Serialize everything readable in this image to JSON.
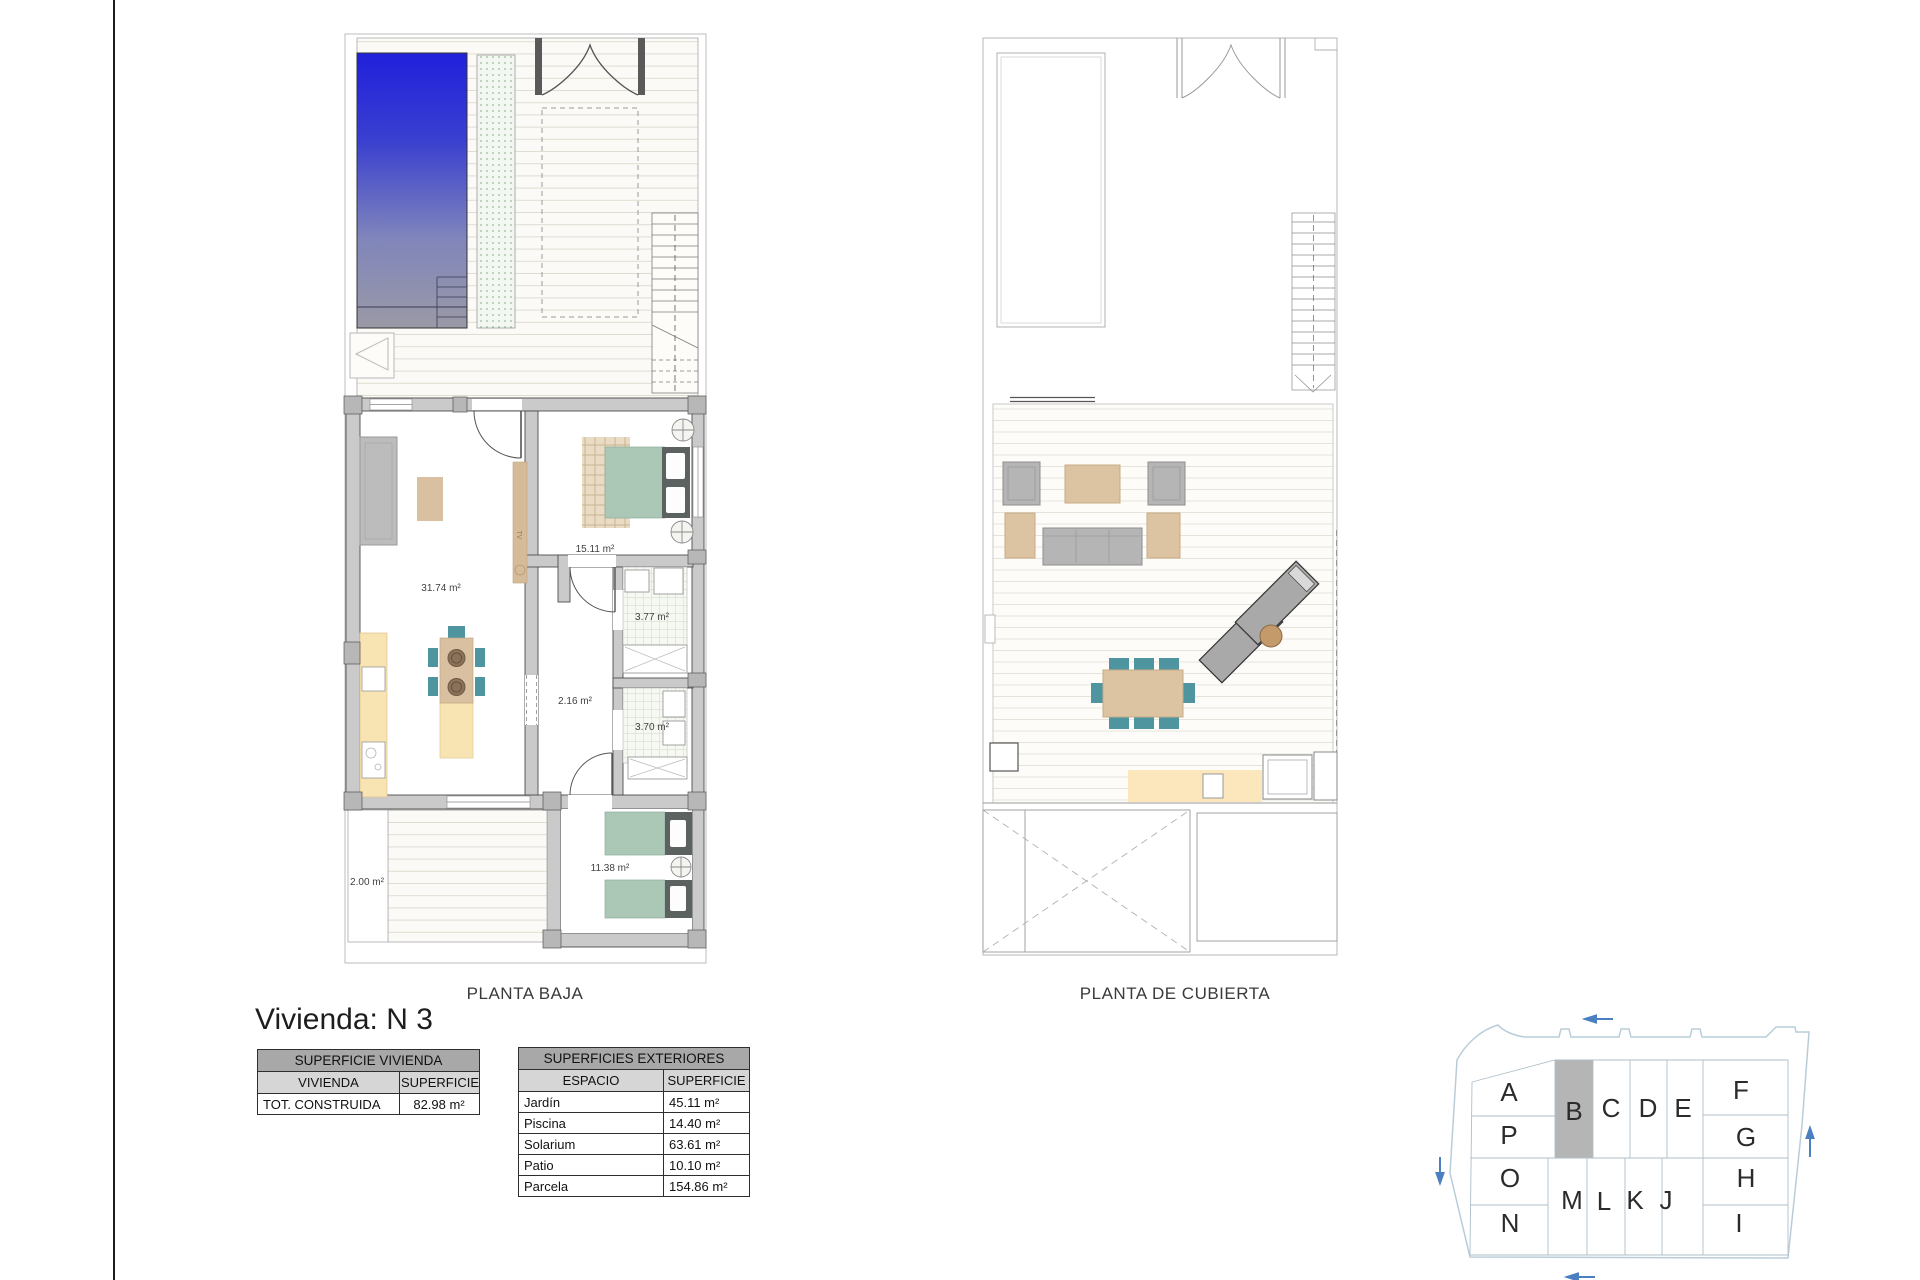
{
  "page": {
    "title": "Vivienda: N 3"
  },
  "captions": {
    "ground": "PLANTA BAJA",
    "roof": "PLANTA DE CUBIERTA"
  },
  "ground_floor": {
    "rooms": {
      "living": "31.74 m²",
      "bedroom_main": "15.11 m²",
      "bath_1": "3.77 m²",
      "hall": "2.16 m²",
      "bath_2": "3.70 m²",
      "bedroom_2": "11.38 m²",
      "patio": "2.00 m²"
    },
    "tv_label": "TV"
  },
  "tables": {
    "vivienda": {
      "title": "SUPERFICIE VIVIENDA",
      "columns": [
        "VIVIENDA",
        "SUPERFICIE"
      ],
      "rows": [
        [
          "TOT. CONSTRUIDA",
          "82.98 m²"
        ]
      ]
    },
    "exteriores": {
      "title": "SUPERFICIES EXTERIORES",
      "columns": [
        "ESPACIO",
        "SUPERFICIE"
      ],
      "rows": [
        [
          "Jardín",
          "45.11 m²"
        ],
        [
          "Piscina",
          "14.40 m²"
        ],
        [
          "Solarium",
          "63.61 m²"
        ],
        [
          "Patio",
          "10.10 m²"
        ],
        [
          "Parcela",
          "154.86 m²"
        ]
      ]
    }
  },
  "siteplan": {
    "highlighted_unit": "B",
    "units": {
      "a": "A",
      "b": "B",
      "c": "C",
      "d": "D",
      "e": "E",
      "f": "F",
      "g": "G",
      "h": "H",
      "i": "I",
      "j": "J",
      "k": "K",
      "l": "L",
      "m": "M",
      "n": "N",
      "o": "O",
      "p": "P"
    }
  },
  "colors": {
    "pool_blue": "#2222DC",
    "unit_highlight": "#B5B5B5",
    "arrow_blue": "#4A7FC1",
    "furniture_teal": "#4E95A0",
    "bed_green": "#ABC7B6",
    "counter_yellow": "#F8E3B2",
    "wood_tan": "#DCC3A2",
    "wall_grey": "#CACACA"
  }
}
